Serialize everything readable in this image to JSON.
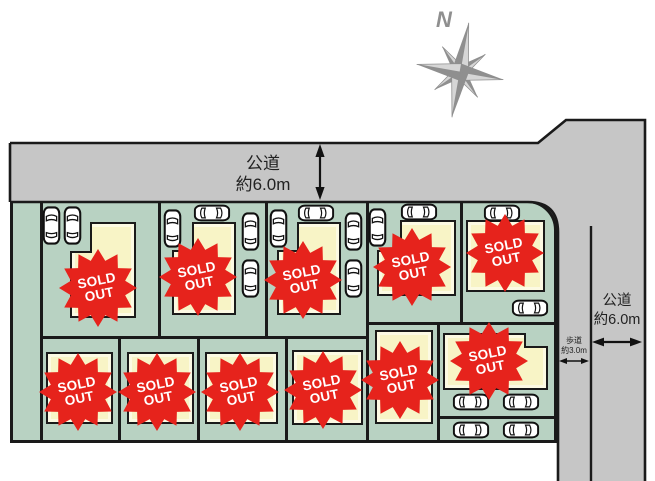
{
  "compass": {
    "north_label": "N"
  },
  "roads": {
    "top_road": {
      "name": "公道",
      "width": "約6.0m"
    },
    "right_road": {
      "name": "公道",
      "width": "約6.0m"
    },
    "sidewalk": {
      "name": "歩道",
      "width": "約3.0m"
    }
  },
  "lots": {
    "count": 11,
    "badge_label": "SOLD OUT"
  },
  "colors": {
    "lot_green": "#b8d2c2",
    "building_cream": "#f8f4c6",
    "road_gray": "#c6c6c6",
    "sold_out_red": "#e6231c",
    "line_black": "#1a1a1a"
  }
}
